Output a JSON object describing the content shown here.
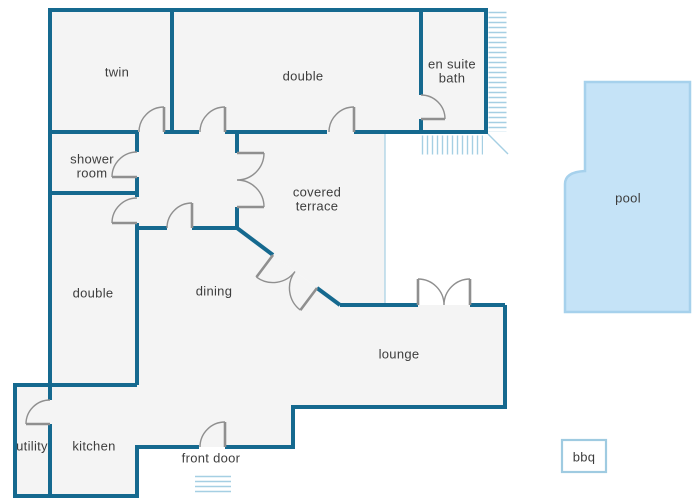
{
  "colors": {
    "background": "#ffffff",
    "wall": "#15698f",
    "floor": "#f4f4f4",
    "door": "#8f8f8f",
    "hatch": "#a5cfe3",
    "pool_fill": "#c5e3f7",
    "pool_edge": "#a6d1ec",
    "bbq_edge": "#9fcbe1",
    "label": "#3d3d3d"
  },
  "labels": {
    "twin": "twin",
    "double_top": "double",
    "ensuite_1": "en suite",
    "ensuite_2": "bath",
    "shower_1": "shower",
    "shower_2": "room",
    "terrace_1": "covered",
    "terrace_2": "terrace",
    "double_left": "double",
    "dining": "dining",
    "lounge": "lounge",
    "utility": "utility",
    "kitchen": "kitchen",
    "front_door": "front door",
    "pool": "pool",
    "bbq": "bbq"
  }
}
